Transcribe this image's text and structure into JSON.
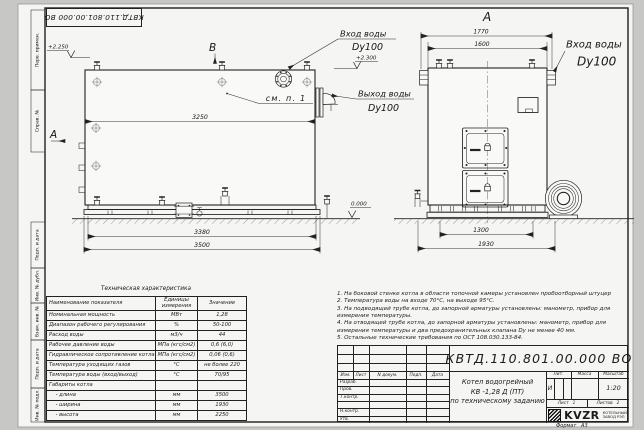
{
  "doc": {
    "number": "КВТД.110.801.00.000  ВО"
  },
  "page": {
    "format": "Формат   А3"
  },
  "margin": {
    "top1": "Перв. примен.",
    "top2": "Справ. №",
    "s1": "Подп. и дата",
    "s2": "Инв. № дубл.",
    "s3": "Взам. инв. №",
    "s4": "Подп. и дата",
    "s5": "Инв. № подл."
  },
  "views": {
    "left": {
      "section_label": "А",
      "view_label": "В",
      "callout": "см. п. 1",
      "level_top": "+2.250",
      "level_inlet": "+2.300",
      "level_zero": "0.000",
      "dim_inner": "3250",
      "dim_base": "3380",
      "dim_overall": "3500",
      "inlet1": "Вход воды",
      "inlet2": "Dy100",
      "outlet1": "Выход воды",
      "outlet2": "Dy100"
    },
    "right": {
      "title": "А",
      "dim_outer": "1770",
      "dim_inner": "1600",
      "dim_base": "1300",
      "dim_overall": "1930",
      "inlet1": "Вход воды",
      "inlet2": "Dy100"
    }
  },
  "table": {
    "title": "Техническая характеристика",
    "col_name": "Наименование показателя",
    "col_units1": "Единицы",
    "col_units2": "измерения",
    "col_value": "Значение",
    "rows": [
      [
        "Номинальная мощность",
        "МВт",
        "1,28"
      ],
      [
        "Диапазон рабочего регулирования",
        "%",
        "50-100"
      ],
      [
        "Расход воды",
        "м3/ч",
        "44"
      ],
      [
        "Рабочее давление воды",
        "МПа (кгс/см2)",
        "0,6 (6,0)"
      ],
      [
        "Гидравлическое сопротивление котла",
        "МПа (кгс/см2)",
        "0,06 (0,6)"
      ],
      [
        "Температура уходящих газов",
        "°С",
        "не более 220"
      ],
      [
        "Температура воды (вход/выход)",
        "°С",
        "70/95"
      ],
      [
        "Габариты котла",
        "",
        ""
      ],
      [
        "    - длина",
        "мм",
        "3500"
      ],
      [
        "    - ширина",
        "мм",
        "1930"
      ],
      [
        "    - высота",
        "мм",
        "2250"
      ]
    ]
  },
  "notes": {
    "lines": [
      "1.  На боковой стенке котла в области топочной камеры установлен пробоотборный штуцер",
      "2.  Температура воды на входе  70°С, на выходе  95°С.",
      "3.  На подводящей трубе котла, до запорной арматуры установлены:  манометр, прибор для",
      "измерения температуры.",
      "4.  На отводящей трубе котла, до запорной арматуры установлены:  манометр, прибор для",
      "измерения температуры и два предохранительных клапана  Dу не менее  40 мм.",
      "5.  Остальные технические требования по ОСТ 108.030.133-84."
    ]
  },
  "tb": {
    "doc_number": "КВТД.110.801.00.000  ВО",
    "name1": "Котел водогрейный",
    "name2": "КВ -1,28  Д  (ПТ)",
    "name3": "по техническому заданию",
    "h_izm": "Изм.",
    "h_list": "Лист",
    "h_ndoc": "N докум.",
    "h_podp": "Подп.",
    "h_data": "Дата",
    "r1": "Разраб.",
    "r2": "Пров.",
    "r3": "Т.контр.",
    "r4": "Н.контр.",
    "r5": "Утв.",
    "lit": "Лит.",
    "massa": "Масса",
    "masshtab": "Масштаб",
    "lit_v": "И",
    "masshtab_v": "1:20",
    "sheet": "Лист",
    "sheet_v": "1",
    "sheets": "Листов",
    "sheets_v": "2",
    "logo": "KVZR",
    "logo1": "КОТЕЛЬНЫЙ",
    "logo2": "ЗАВОД РЭП"
  }
}
